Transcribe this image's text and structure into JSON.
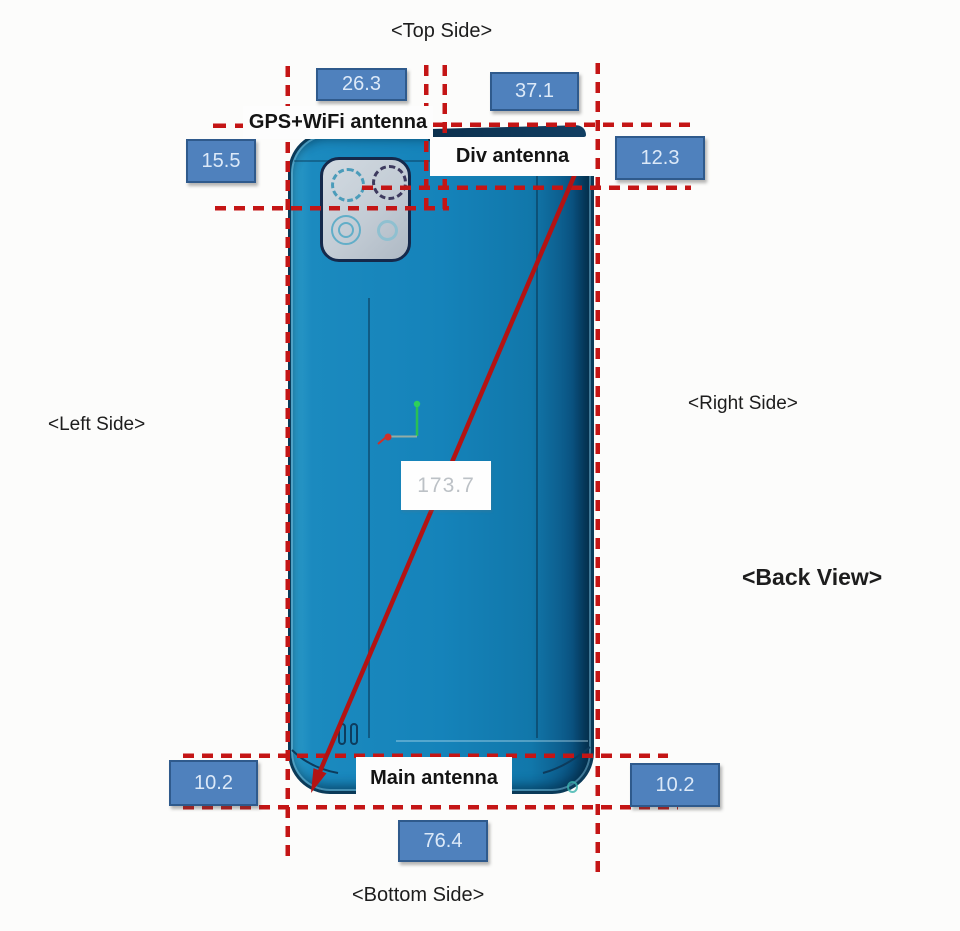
{
  "diagram": {
    "title": "Phone back view antenna location diagram",
    "view_label": "<Back View>",
    "sides": {
      "top": "<Top Side>",
      "left": "<Left Side>",
      "right": "<Right Side>",
      "bottom": "<Bottom Side>"
    },
    "antennas": {
      "gps_wifi": "GPS+WiFi antenna",
      "div": "Div antenna",
      "main": "Main antenna"
    },
    "dimensions_mm": {
      "top_left_offset": "26.3",
      "top_right_offset": "37.1",
      "left_top_offset": "15.5",
      "right_top_offset": "12.3",
      "bottom_left_offset": "10.2",
      "bottom_right_offset": "10.2",
      "bottom_width": "76.4",
      "diagonal_length": "173.7"
    },
    "colors": {
      "dimension_box_fill": "#4f81bd",
      "dimension_box_border": "#2f5a8c",
      "dimension_box_text": "#dce9f8",
      "measurement_dash_red": "#c41515",
      "diagonal_line_red": "#b31313",
      "phone_body_blue": "#1583ba",
      "phone_edge_dark": "#0a3a58",
      "camera_plate_gray": "#c3ccd5",
      "origin_marker_green": "#2ed05a",
      "origin_marker_red": "#d03028"
    }
  }
}
